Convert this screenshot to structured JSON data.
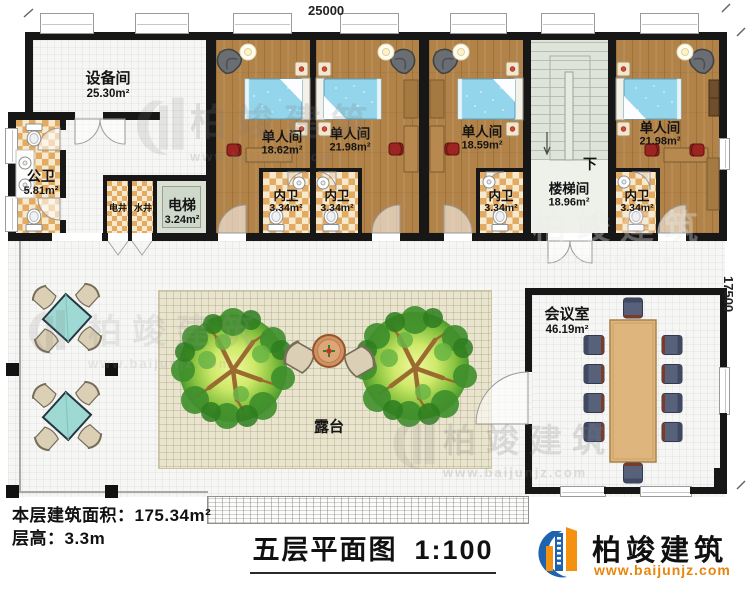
{
  "dimensions": {
    "top": "25000",
    "right": "17500"
  },
  "rooms": {
    "equipment": {
      "name": "设备间",
      "area": "25.30m²"
    },
    "public_wc": {
      "name": "公卫",
      "area": "5.81m²"
    },
    "elec_shaft": {
      "name": "电井"
    },
    "water_shaft": {
      "name": "水井"
    },
    "elevator": {
      "name": "电梯",
      "area": "3.24m²"
    },
    "bedroom1": {
      "name": "单人间",
      "area": "18.62m²"
    },
    "bedroom2": {
      "name": "单人间",
      "area": "21.98m²"
    },
    "bedroom3": {
      "name": "单人间",
      "area": "18.59m²"
    },
    "bedroom4": {
      "name": "单人间",
      "area": "21.98m²"
    },
    "ensuite1": {
      "name": "内卫",
      "area": "3.34m²"
    },
    "ensuite2": {
      "name": "内卫",
      "area": "3.34m²"
    },
    "ensuite3": {
      "name": "内卫",
      "area": "3.34m²"
    },
    "ensuite4": {
      "name": "内卫",
      "area": "3.34m²"
    },
    "stairwell": {
      "name": "楼梯间",
      "area": "18.96m²",
      "down": "下"
    },
    "meeting": {
      "name": "会议室",
      "area": "46.19m²"
    },
    "terrace": {
      "name": "露台"
    }
  },
  "footer": {
    "floor_area_label": "本层建筑面积：",
    "floor_area_value": "175.34m²",
    "floor_height_label": "层高：",
    "floor_height_value": "3.3m"
  },
  "title": {
    "text": "五层平面图",
    "scale": "1:100"
  },
  "brand": {
    "name": "柏竣建筑",
    "url": "www.baijunjz.com"
  },
  "watermark": {
    "name": "柏竣建筑",
    "url": "www.baijunjz.com"
  },
  "colors": {
    "wall": "#171717",
    "wood_floor": "#b28349",
    "checker_dark": "#e3aa62",
    "checker_light": "#f6e9ce",
    "blanket_blue": "#93d5eb",
    "patio_beige": "#e9e4cd",
    "elevator_green": "#cfd9cb",
    "brand_blue": "#1e63ae",
    "brand_orange": "#f49110",
    "table_teal": "#9ed9d4",
    "conference_table": "#deb57c"
  }
}
